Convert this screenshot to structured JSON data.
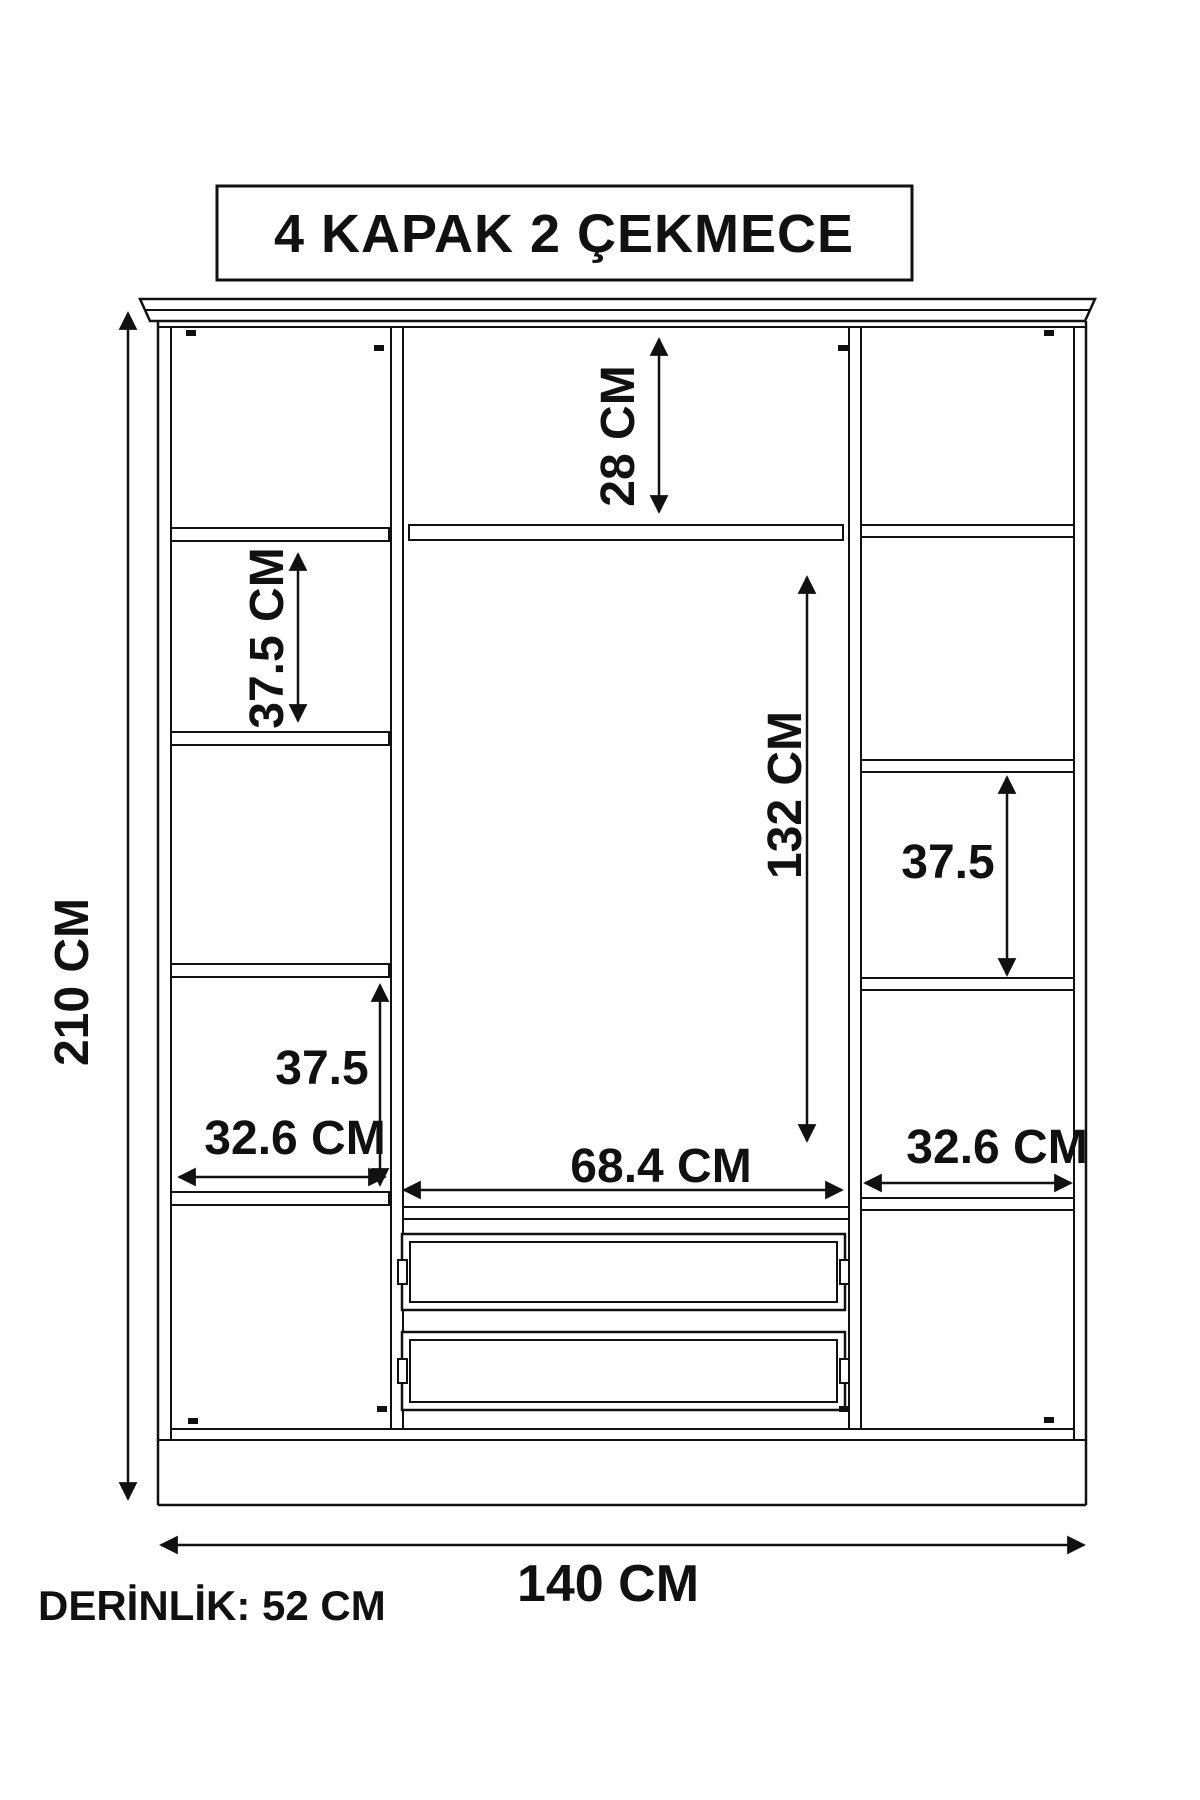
{
  "colors": {
    "background": "#ffffff",
    "line": "#111111",
    "text": "#111111"
  },
  "title": {
    "text": "4 KAPAK 2 ÇEKMECE"
  },
  "dimensions": {
    "overall_height": "210 CM",
    "overall_width": "140 CM",
    "top_compartment_height": "28 CM",
    "left_upper_compartment_height": "37.5 CM",
    "center_compartment_height": "132 CM",
    "right_compartment_height": "37.5",
    "left_lower_compartment_height": "37.5",
    "left_column_width": "32.6 CM",
    "center_column_width": "68.4 CM",
    "right_column_width": "32.6 CM",
    "depth": "DERİNLİK: 52 CM"
  }
}
